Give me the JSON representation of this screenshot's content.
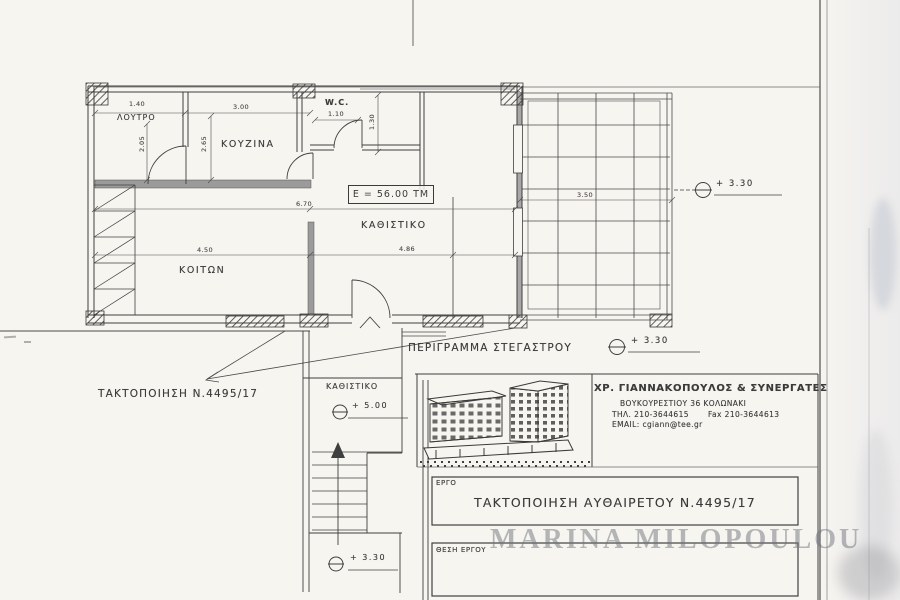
{
  "sheet": {
    "paper_color": "#f7f5f0",
    "ink_color": "#3b3b3b",
    "watermark": "MARINA MILOPOULOU"
  },
  "plan": {
    "rooms": {
      "loutro": "ΛΟΥΤΡΟ",
      "kouzina": "ΚΟΥΖΙΝΑ",
      "wc": "W.C.",
      "kathistiko": "ΚΑΘΙΣΤΙΚΟ",
      "koiton": "ΚΟΙΤΩΝ",
      "kathistiko_stair": "ΚΑΘΙΣΤΙΚΟ"
    },
    "area_label": "Ε = 56.00 ΤΜ",
    "dims": {
      "w_loutro": "1.40",
      "w_kouzina": "3.00",
      "h_loutro": "2.05",
      "h_kouzina": "2.65",
      "w_wc": "1.10",
      "h_wc": "1.30",
      "w_total": "6.70",
      "w_koiton": "4.50",
      "w_kathistiko": "4.86",
      "w_terrace": "3.50"
    },
    "elevations": {
      "terrace": "+  3.30",
      "canopy": "+  3.30",
      "stair_mid": "+  5.00",
      "stair_base": "+  3.30"
    },
    "annotations": {
      "canopy_outline": "ΠΕΡΙΓΡΑΜΜΑ ΣΤΕΓΑΣΤΡΟΥ",
      "regularization": "ΤΑΚΤΟΠΟΙΗΣΗ Ν.4495/17"
    }
  },
  "title_block": {
    "firm": "ΧΡ. ΓΙΑΝΝΑΚΟΠΟΥΛΟΣ  &  ΣΥΝΕΡΓΑΤΕΣ",
    "address": "ΒΟΥΚΟΥΡΕΣΤΙΟΥ 36  ΚΟΛΩΝΑΚΙ",
    "tel": "ΤΗΛ.  210-3644615",
    "fax": "Fax 210-3644613",
    "email": "EMAIL: cgiann@tee.gr",
    "project_label": "ΕΡΓΟ",
    "project_title": "ΤΑΚΤΟΠΟΙΗΣΗ ΑΥΘΑΙΡΕΤΟΥ Ν.4495/17",
    "location_label": "ΘΕΣΗ ΕΡΓΟΥ"
  }
}
